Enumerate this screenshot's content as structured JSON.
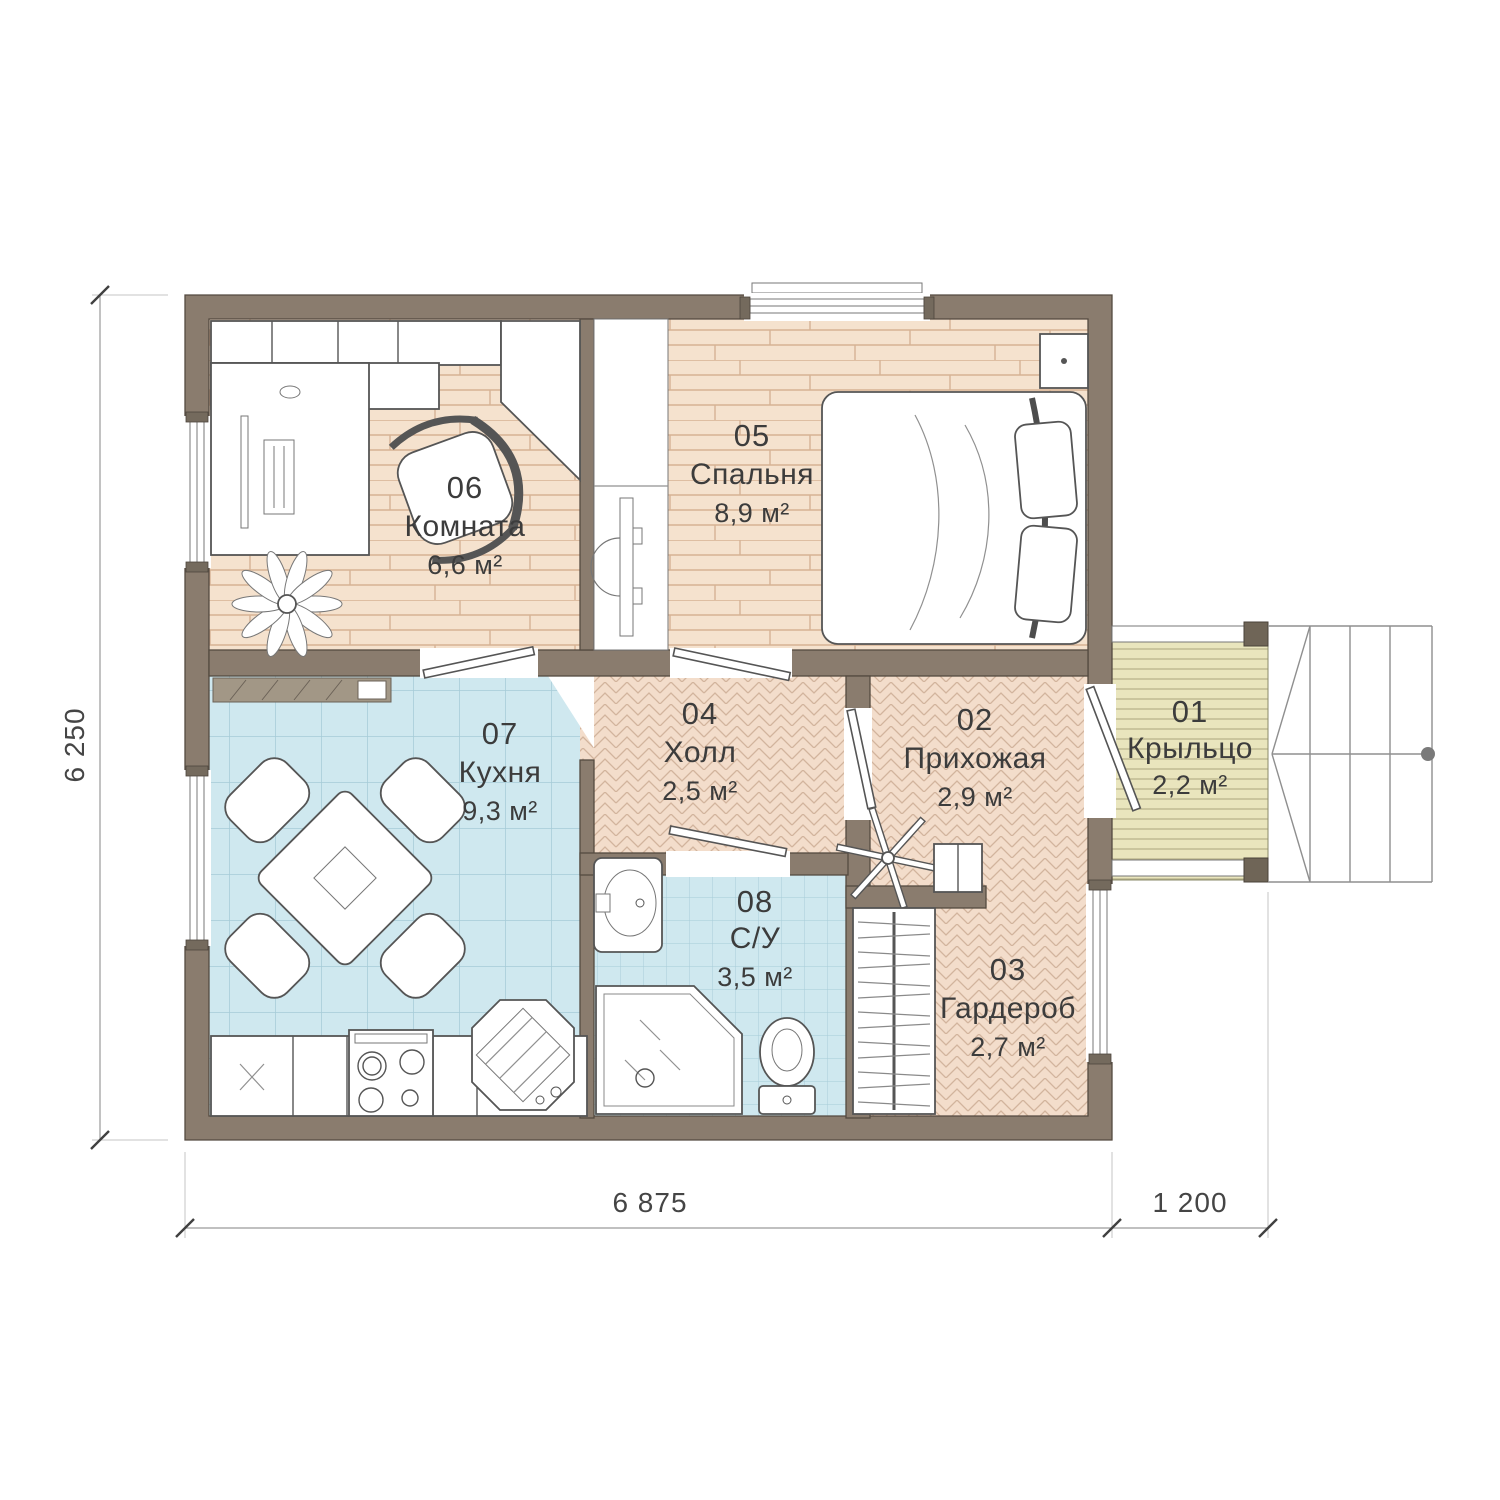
{
  "plan": {
    "rooms": {
      "r01": {
        "num": "01",
        "name": "Крыльцо",
        "area": "2,2 м²"
      },
      "r02": {
        "num": "02",
        "name": "Прихожая",
        "area": "2,9 м²"
      },
      "r03": {
        "num": "03",
        "name": "Гардероб",
        "area": "2,7 м²"
      },
      "r04": {
        "num": "04",
        "name": "Холл",
        "area": "2,5 м²"
      },
      "r05": {
        "num": "05",
        "name": "Спальня",
        "area": "8,9 м²"
      },
      "r06": {
        "num": "06",
        "name": "Комната",
        "area": "6,6 м²"
      },
      "r07": {
        "num": "07",
        "name": "Кухня",
        "area": "9,3 м²"
      },
      "r08": {
        "num": "08",
        "name": "С/У",
        "area": "3,5 м²"
      }
    },
    "dimensions": {
      "height_total": "6 250",
      "width_main": "6 875",
      "width_porch": "1 200"
    },
    "colors": {
      "wall": "#8a7c6e",
      "wood_floor": "#f5e2ce",
      "parquet_floor": "#f3ddcb",
      "tile_floor": "#cfe8ef",
      "deck_floor": "#e9e5bd"
    }
  }
}
